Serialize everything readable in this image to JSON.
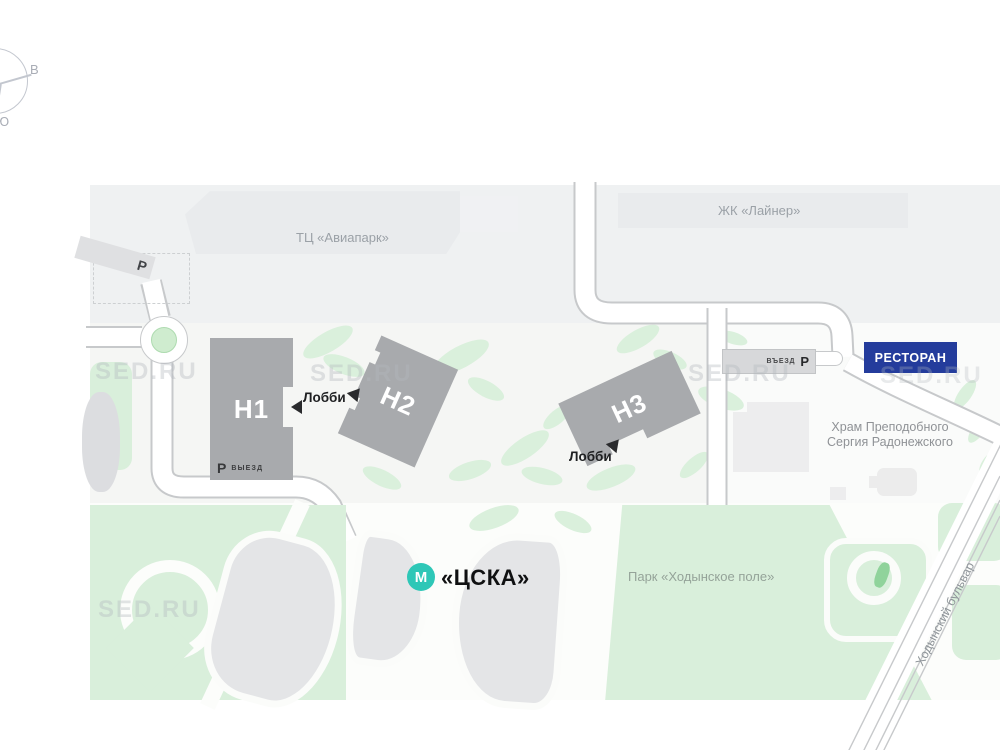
{
  "title": "Site plan map",
  "compass": {
    "east": "В",
    "south": "Ю"
  },
  "landmarks": {
    "mall": "ТЦ «Авиапарк»",
    "residential_complex": "ЖК «Лайнер»",
    "church_line1": "Храм Преподобного",
    "church_line2": "Сергия Радонежского",
    "park": "Парк «Ходынское поле»",
    "street": "Ходынский бульвар",
    "restaurant": "РЕСТОРАН"
  },
  "towers": [
    {
      "label": "Н1"
    },
    {
      "label": "Н2"
    },
    {
      "label": "Н3"
    }
  ],
  "lobby": {
    "label": "Лобби"
  },
  "parking": {
    "symbol": "Р",
    "exit_label": "ВЫЕЗД",
    "entrance_label": "ВЪЕЗД"
  },
  "metro": {
    "symbol": "М",
    "station": "«ЦСКА»"
  },
  "watermark": "SED.RU",
  "colors": {
    "tower_gray": "#a8aaad",
    "building_light_gray": "#e9ebed",
    "park_green": "#d9efdb",
    "metro_teal": "#2ec7b7",
    "restaurant_blue": "#243c9c",
    "road_outline": "#c7c9cb"
  }
}
